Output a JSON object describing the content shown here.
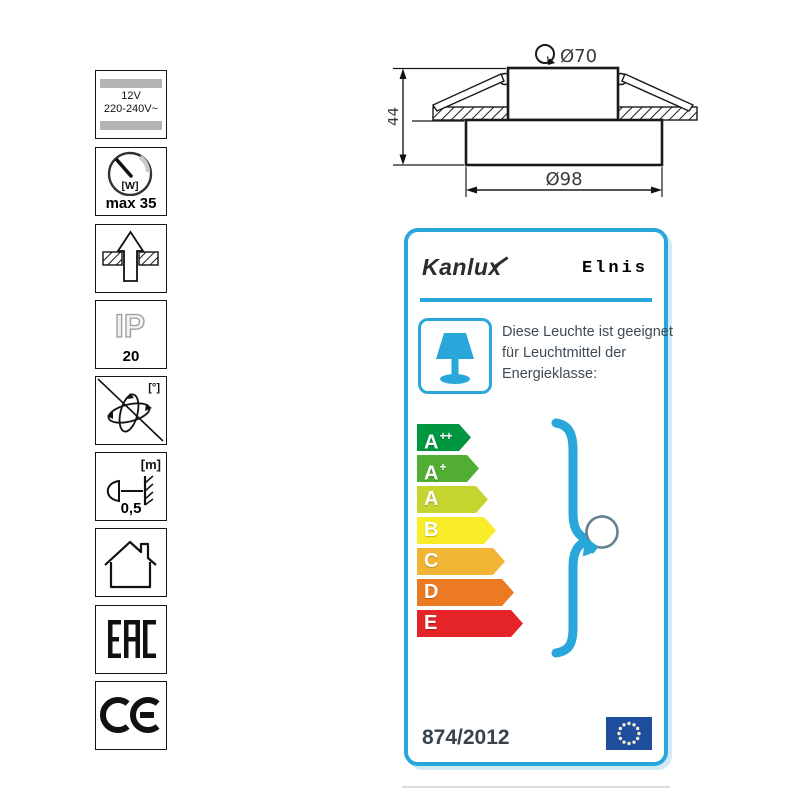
{
  "spec_icons": [
    {
      "name": "voltage",
      "line1": "12V",
      "line2": "220-240V~"
    },
    {
      "name": "max-wattage",
      "unit": "[W]",
      "caption": "max 35"
    },
    {
      "name": "recessed-mounting"
    },
    {
      "name": "ip-rating",
      "code": "IP",
      "caption": "20"
    },
    {
      "name": "not-adjustable",
      "unit": "[°]"
    },
    {
      "name": "min-distance",
      "unit": "[m]",
      "caption": "0,5"
    },
    {
      "name": "indoor-use"
    },
    {
      "name": "eac-mark",
      "label": "EAC"
    },
    {
      "name": "ce-mark",
      "label": "CE"
    }
  ],
  "drawing": {
    "dim_cutout": "Ø70",
    "dim_height": "44",
    "dim_outer": "Ø98"
  },
  "energy_label": {
    "brand": "Kanlux",
    "model": "Elnis",
    "description": "Diese Leuchte ist geeignet für Leuchtmittel der Energieklasse:",
    "regulation": "874/2012",
    "accent_color": "#29A7DA",
    "classes": [
      {
        "base": "A",
        "sup": "++",
        "color": "#009640",
        "width": 54
      },
      {
        "base": "A",
        "sup": "+",
        "color": "#52AE32",
        "width": 62
      },
      {
        "base": "A",
        "sup": "",
        "color": "#C5D42E",
        "width": 71
      },
      {
        "base": "B",
        "sup": "",
        "color": "#F8EC28",
        "width": 79
      },
      {
        "base": "C",
        "sup": "",
        "color": "#F1B434",
        "width": 88
      },
      {
        "base": "D",
        "sup": "",
        "color": "#EC7A23",
        "width": 97
      },
      {
        "base": "E",
        "sup": "",
        "color": "#E42429",
        "width": 106
      }
    ]
  }
}
